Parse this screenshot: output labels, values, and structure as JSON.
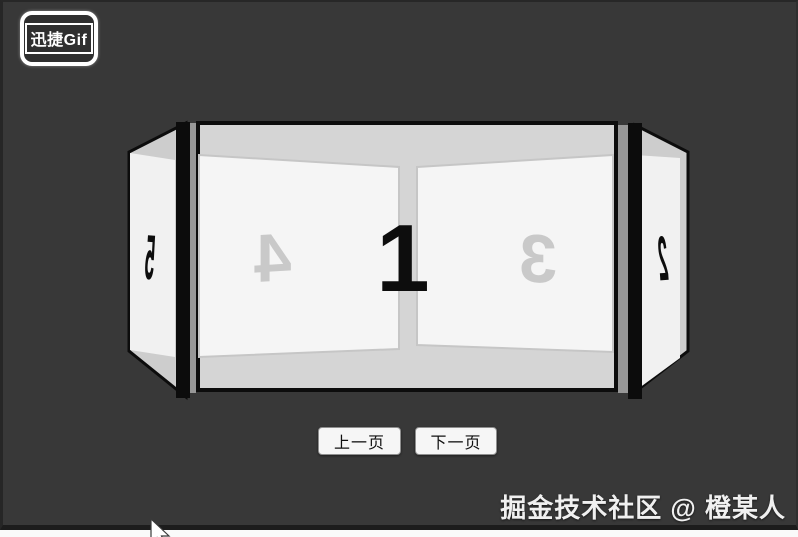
{
  "app": {
    "logo_text": "迅捷Gif"
  },
  "carousel": {
    "pages": [
      {
        "number": "1",
        "position": "front"
      },
      {
        "number": "2",
        "position": "right-side"
      },
      {
        "number": "3",
        "position": "back-right"
      },
      {
        "number": "4",
        "position": "back-left"
      },
      {
        "number": "5",
        "position": "left-side"
      }
    ]
  },
  "controls": {
    "prev": "上一页",
    "next": "下一页"
  },
  "watermark": "掘金技术社区 @ 橙某人",
  "colors": {
    "background": "#383838",
    "frame_border": "#0c0c0c",
    "frame_fill": "#d5d5d5",
    "panel_face": "#f5f5f5",
    "side_face": "#f1f1f1",
    "side_fill": "#cdcdcd",
    "back_number": "#c9c9c9",
    "front_number": "#0d0d0d"
  }
}
